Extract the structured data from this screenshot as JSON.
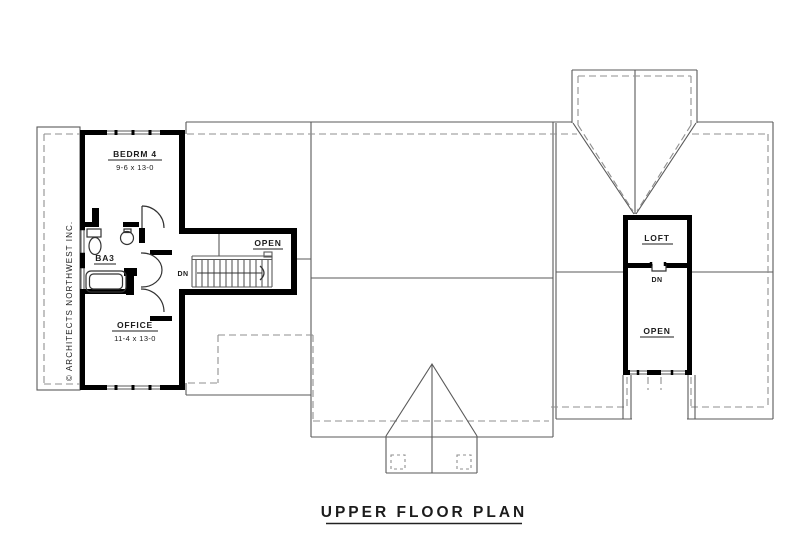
{
  "title": {
    "label": "UPPER FLOOR PLAN"
  },
  "watermark": {
    "label": "© ARCHITECTS NORTHWEST INC."
  },
  "rooms": {
    "bedroom4": {
      "name": "BEDRM 4",
      "dims": "9-6 x 13-0"
    },
    "bath": {
      "name": "BA3"
    },
    "office": {
      "name": "OFFICE",
      "dims": "11-4 x 13-0"
    },
    "stair_hall": {
      "open": "OPEN",
      "down": "DN"
    },
    "loft": {
      "name": "LOFT",
      "down": "DN",
      "open": "OPEN"
    }
  },
  "colors": {
    "walls": "#000000",
    "outline": "#5a5a5a",
    "roof_dashed": "#8f8f8f",
    "text": "#1c1c1c",
    "background": "#ffffff"
  }
}
